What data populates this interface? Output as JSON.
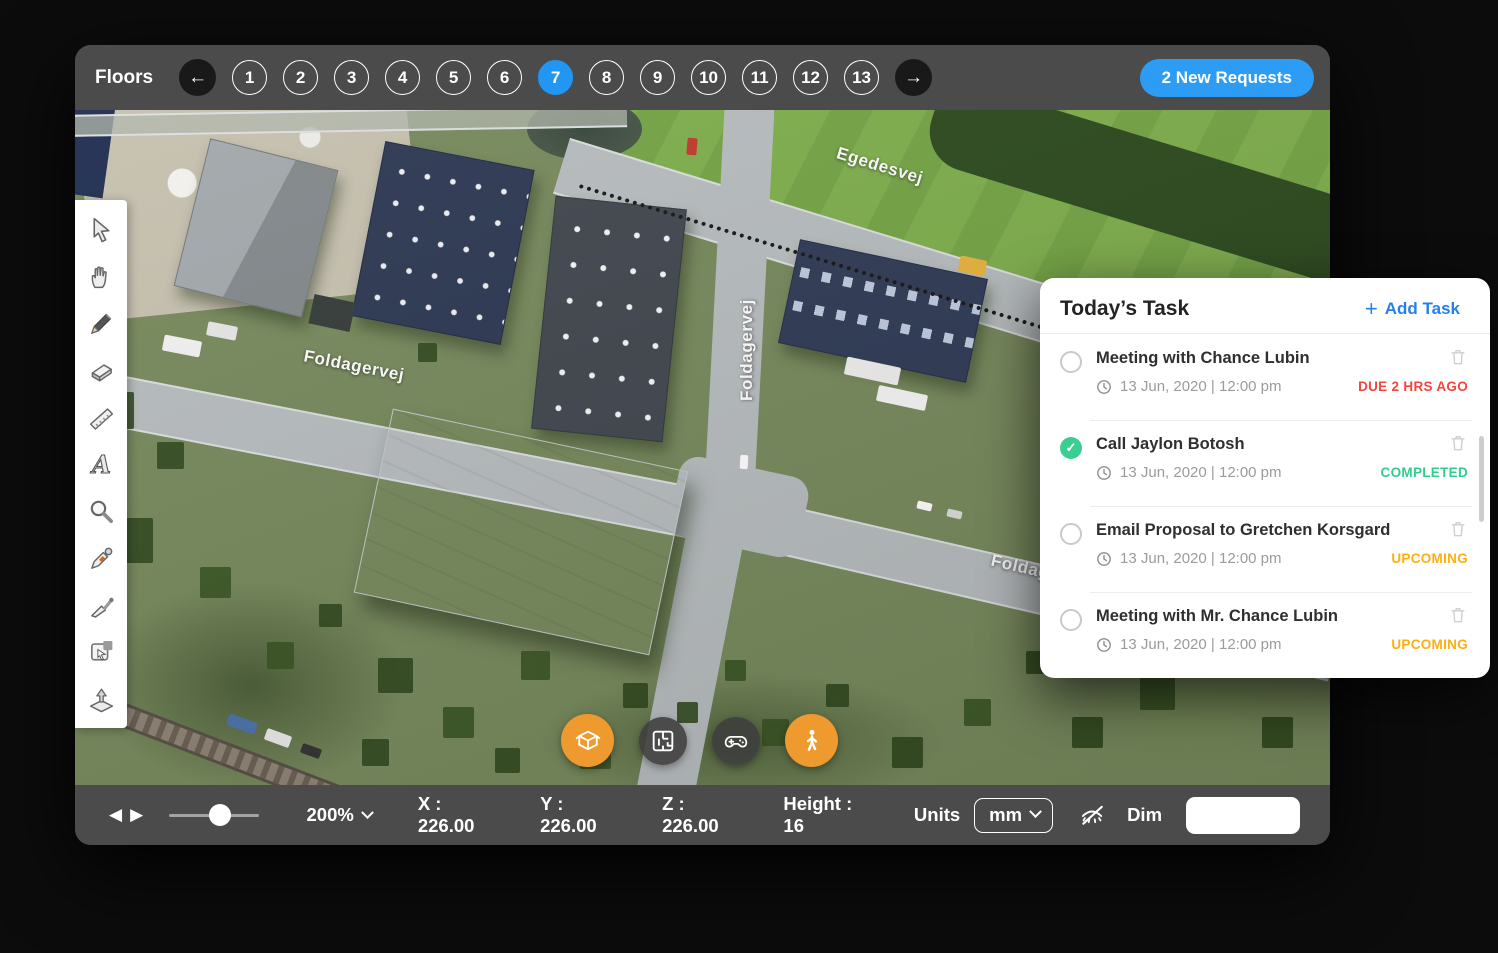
{
  "colors": {
    "accent_blue": "#2196F3",
    "button_blue": "#2D9CF4",
    "link_blue": "#2680EC",
    "status_due_red": "#F2453D",
    "status_completed_green": "#2FCE8F",
    "status_upcoming_amber": "#FFAE10",
    "view_button_orange": "#EE9A2F",
    "bar_gray": "#4b4b4b"
  },
  "icons": {
    "back_arrow": "←",
    "forward_arrow": "→",
    "prev_tri": "◀",
    "next_tri": "▶",
    "plus": "+",
    "check": "✓"
  },
  "topbar": {
    "floors_label": "Floors",
    "floors": [
      "1",
      "2",
      "3",
      "4",
      "5",
      "6",
      "7",
      "8",
      "9",
      "10",
      "11",
      "12",
      "13"
    ],
    "selected_floor": "7",
    "new_requests": "2 New Requests"
  },
  "toolbar": {
    "tools": [
      "pointer",
      "hand",
      "pencil",
      "eraser",
      "ruler",
      "text",
      "zoom",
      "eyedropper",
      "trowel",
      "area-select",
      "extrude"
    ]
  },
  "map": {
    "streets": [
      "Egedesvej",
      "Foldagervej",
      "Foldagervej",
      "Foldagervej"
    ],
    "view_buttons": [
      "cube-view",
      "floorplan-view",
      "gamepad-view",
      "walk-view"
    ]
  },
  "tasks": {
    "title": "Today’s Task",
    "add_label": "Add Task",
    "items": [
      {
        "title": "Meeting with Chance Lubin",
        "datetime": "13 Jun, 2020 | 12:00 pm",
        "status": "DUE 2 HRS AGO",
        "state": "due"
      },
      {
        "title": "Call Jaylon Botosh",
        "datetime": "13 Jun, 2020 | 12:00 pm",
        "status": "COMPLETED",
        "state": "completed"
      },
      {
        "title": "Email Proposal to Gretchen Korsgard",
        "datetime": "13 Jun, 2020 | 12:00 pm",
        "status": "UPCOMING",
        "state": "upcoming"
      },
      {
        "title": "Meeting with Mr. Chance Lubin",
        "datetime": "13 Jun, 2020 | 12:00 pm",
        "status": "UPCOMING",
        "state": "upcoming"
      }
    ]
  },
  "bottombar": {
    "zoom": "200%",
    "readouts": [
      "X : 226.00",
      "Y : 226.00",
      "Z : 226.00",
      "Height : 16"
    ],
    "units_label": "Units",
    "units_value": "mm",
    "dim_label": "Dim",
    "dim_value": ""
  }
}
